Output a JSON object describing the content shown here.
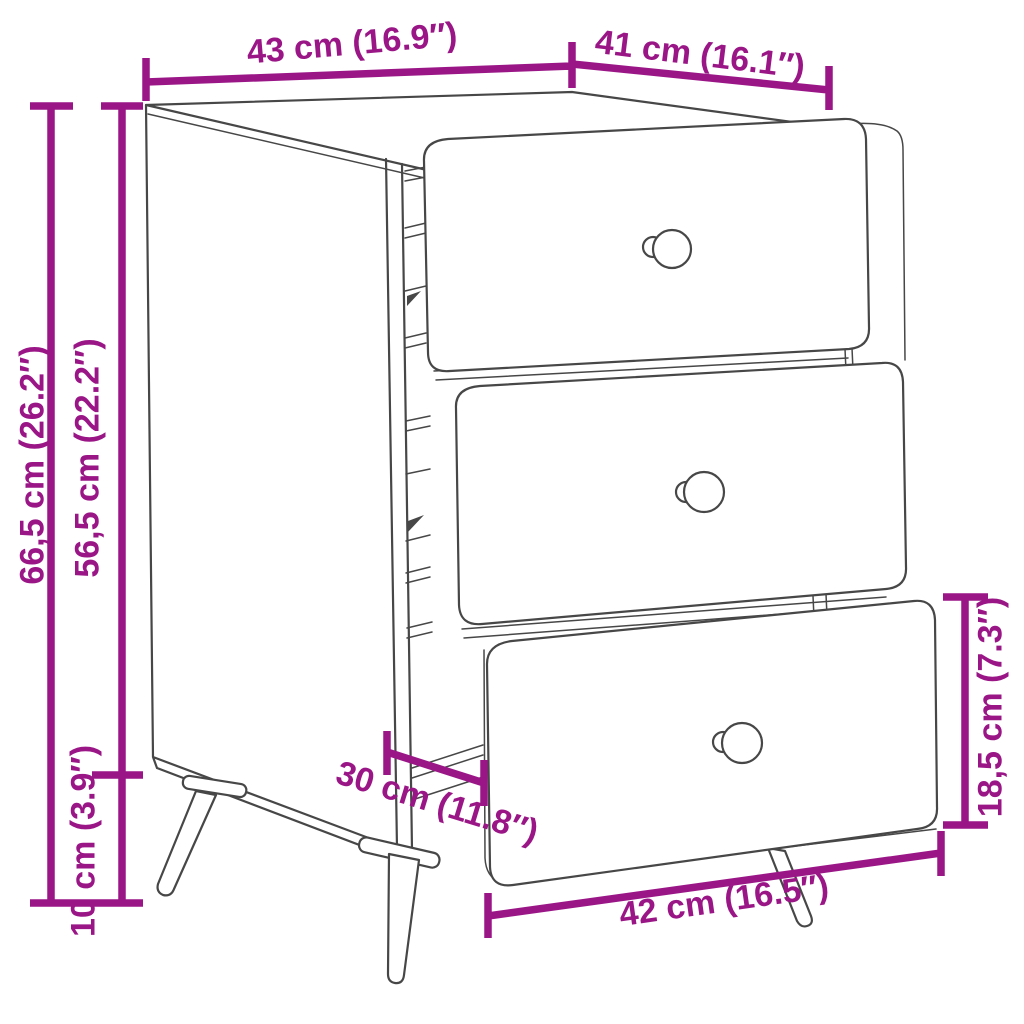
{
  "diagram": {
    "accent_color": "#9A1687",
    "line_color": "#474747",
    "labels": {
      "top_width": "43 cm (16.9″)",
      "top_depth": "41 cm (16.1″)",
      "overall_height": "66,5 cm (26.2″)",
      "body_height": "56,5 cm (22.2″)",
      "leg_height": "10 cm (3.9″)",
      "inner_depth": "30 cm (11.8″)",
      "drawer_height": "18,5 cm (7.3″)",
      "drawer_width": "42 cm (16.5″)"
    }
  }
}
